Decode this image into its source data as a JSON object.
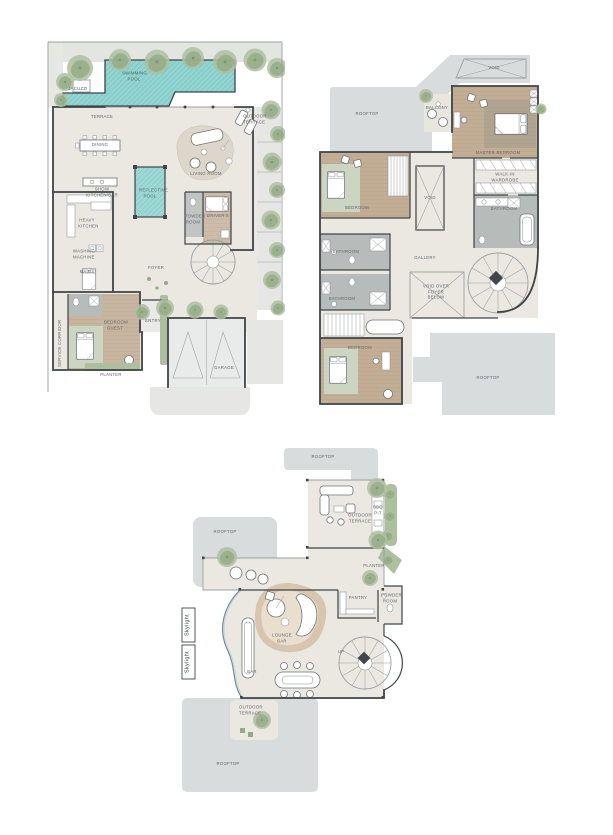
{
  "document": {
    "background": "#ffffff",
    "description": "Three architectural floor plans of a villa"
  },
  "colors": {
    "rooftop_gray": "#d9dcdc",
    "floor_beige": "#eae8e1",
    "wall_dark": "#3f4447",
    "pool_teal": "#8fd0cd",
    "wood_brown": "#c2ad95",
    "tile_gray": "#b7bcba",
    "greenery": "#aebfa0",
    "label_gray": "#63676a"
  },
  "ground_floor": {
    "labels": {
      "jacuzzi": "JACUZZI",
      "swimming_pool": "SWIMMING POOL",
      "terrace": "TERRACE",
      "outdoor_terrace": "OUTDOOR TERRACE",
      "dining": "DINING",
      "show_kitchen_bar": "SHOW KITCHEN/BAR",
      "reflective_pool": "REFLECTIVE POOL",
      "living_room": "LIVING ROOM",
      "heavy_kitchen": "HEAVY KITCHEN",
      "washing_machine": "WASHING MACHINE",
      "maids": "MAIDS",
      "bedroom_guest": "BEDROOM GUEST",
      "service_corridor": "SERVICE CORRIDOR",
      "entry": "ENTRY",
      "foyer": "FOYER",
      "powder_room": "POWDER ROOM",
      "drivers": "DRIVER'S",
      "garage": "GARAGE",
      "planter": "PLANTER"
    }
  },
  "first_floor": {
    "labels": {
      "void_top": "VOID",
      "rooftop_upper": "ROOFTOP",
      "balcony": "BALCONY",
      "master_bedroom": "MASTER BEDROOM",
      "walk_in_wardrobe": "WALK-IN WARDROBE",
      "bathroom_master": "BATHROOM",
      "bedroom_left": "BEDROOM",
      "bathroom_1": "BATHROOM",
      "bathroom_2": "BATHROOM",
      "gallery": "GALLERY",
      "void_shaft": "VOID",
      "void_over_foyer": "VOID OVER FOYER BELOW",
      "bedroom_lower": "BEDROOM",
      "rooftop_lower": "ROOFTOP"
    }
  },
  "roof_floor": {
    "labels": {
      "rooftop_top": "ROOFTOP",
      "rooftop_left": "ROOFTOP",
      "rooftop_bottom": "ROOFTOP",
      "outdoor_terrace": "OUTDOOR TERRACE",
      "bbq_pit": "BBQ PIT",
      "planter": "PLANTER",
      "pantry": "PANTRY",
      "powder_room": "POWDER ROOM",
      "lounge_bar": "LOUNGE BAR",
      "bar": "BAR",
      "up": "UP",
      "skylight_a": "Skylight",
      "skylight_b": "Skylight",
      "outdoor_terrace_small": "OUTDOOR TERRACE"
    }
  }
}
